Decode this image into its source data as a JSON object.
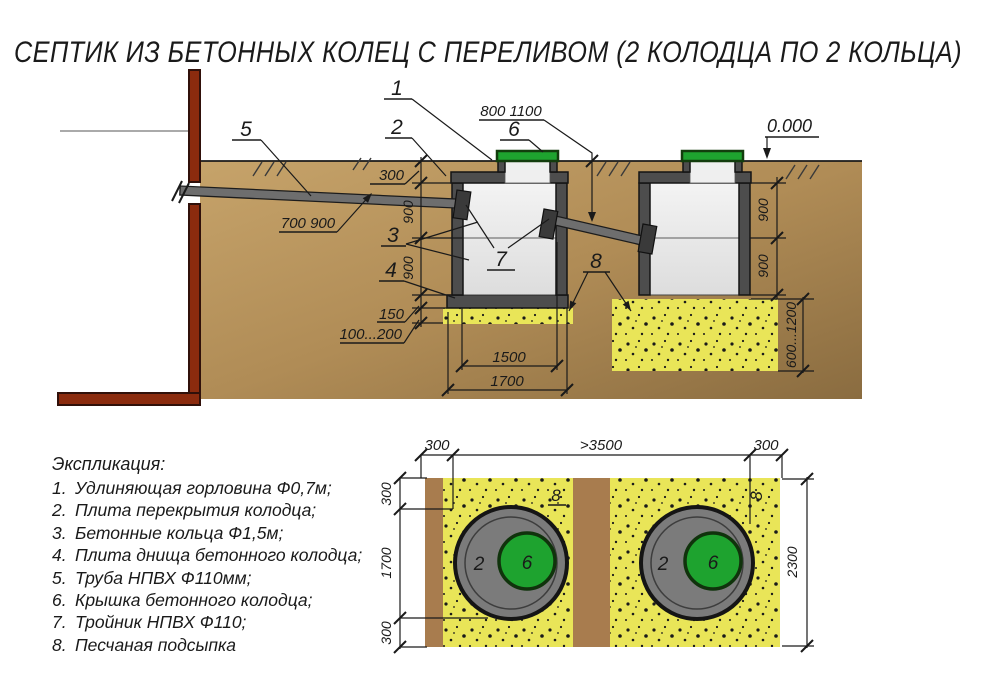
{
  "title": "СЕПТИК ИЗ БЕТОННЫХ КОЛЕЦ С ПЕРЕЛИВОМ (2 КОЛОДЦА ПО 2 КОЛЬЦА)",
  "section": {
    "elevation_mark": "0.000",
    "callouts": {
      "c1": "1",
      "c2": "2",
      "c3": "3",
      "c4": "4",
      "c5": "5",
      "c6": "6",
      "c7": "7",
      "c8": "8"
    },
    "dims": {
      "cover_depth": "300",
      "ring_height": "900",
      "slab_thickness": "150",
      "bedding_thickness": "100...200",
      "inlet_pipe_depth": "700 900",
      "overflow_pipe_depth": "800 1100",
      "pit_depth": "600...1200",
      "ring_inner_width": "1500",
      "ring_outer_width": "1700"
    }
  },
  "plan": {
    "callouts": {
      "ring": "2",
      "cover": "6",
      "sand_left": "8",
      "sand_right": "8"
    },
    "dims": {
      "edge_left": "300",
      "span": ">3500",
      "edge_right": "300",
      "height": "2300",
      "offset_top": "300",
      "well_outer": "1700",
      "offset_bottom": "300"
    }
  },
  "legend": {
    "heading": "Экспликация:",
    "items": [
      {
        "n": "1.",
        "t": "Удлиняющая горловина Ф0,7м;"
      },
      {
        "n": "2.",
        "t": "Плита перекрытия колодца;"
      },
      {
        "n": "3.",
        "t": "Бетонные кольца Ф1,5м;"
      },
      {
        "n": "4.",
        "t": "Плита днища бетонного колодца;"
      },
      {
        "n": "5.",
        "t": "Труба НПВХ Ф110мм;"
      },
      {
        "n": "6.",
        "t": "Крышка бетонного колодца;"
      },
      {
        "n": "7.",
        "t": "Тройник НПВХ Ф110;"
      },
      {
        "n": "8.",
        "t": "Песчаная подсыпка"
      }
    ]
  },
  "colors": {
    "soil": "#b08c56",
    "sand": "#e9e558",
    "concrete": "#4d4d4d",
    "lid_green": "#1ea32f",
    "wall_red": "#8b2b0e"
  }
}
